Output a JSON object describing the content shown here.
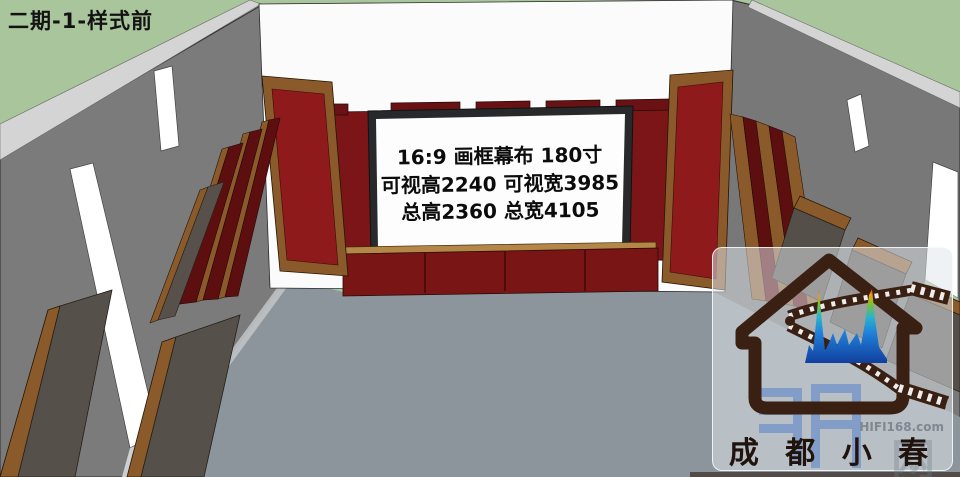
{
  "title": "二期-1-样式前",
  "screen": {
    "line1": "16:9 画框幕布 180寸",
    "line2": "可视高2240 可视宽3985",
    "line3": "总高2360 总宽4105"
  },
  "logo": {
    "brand": "成 都 小 春",
    "watermark": "HIFI168.com",
    "watermark_char": "网",
    "icon": "house-with-film-strip-and-audio-spectrum"
  },
  "colors": {
    "background_green": "#a9c59c",
    "wall_gray": "#7b7b7b",
    "wall_trim": "#d4d4d4",
    "floor_gray": "#8c959b",
    "front_wall_white": "#fbfbfb",
    "panel_red": "#8e1a1b",
    "back_wall_red": "#7c1517",
    "panel_maroon": "#5d0f10",
    "panel_dark_fabric": "#55504a",
    "wood_frame": "#8a5a2a",
    "platform_red": "#7a1516",
    "platform_wood": "#b48747",
    "screen_white": "#fdfdfd",
    "screen_frame": "#27292b",
    "logo_brown": "#3a2013",
    "spectrum_blue": "#1f7fd8"
  }
}
